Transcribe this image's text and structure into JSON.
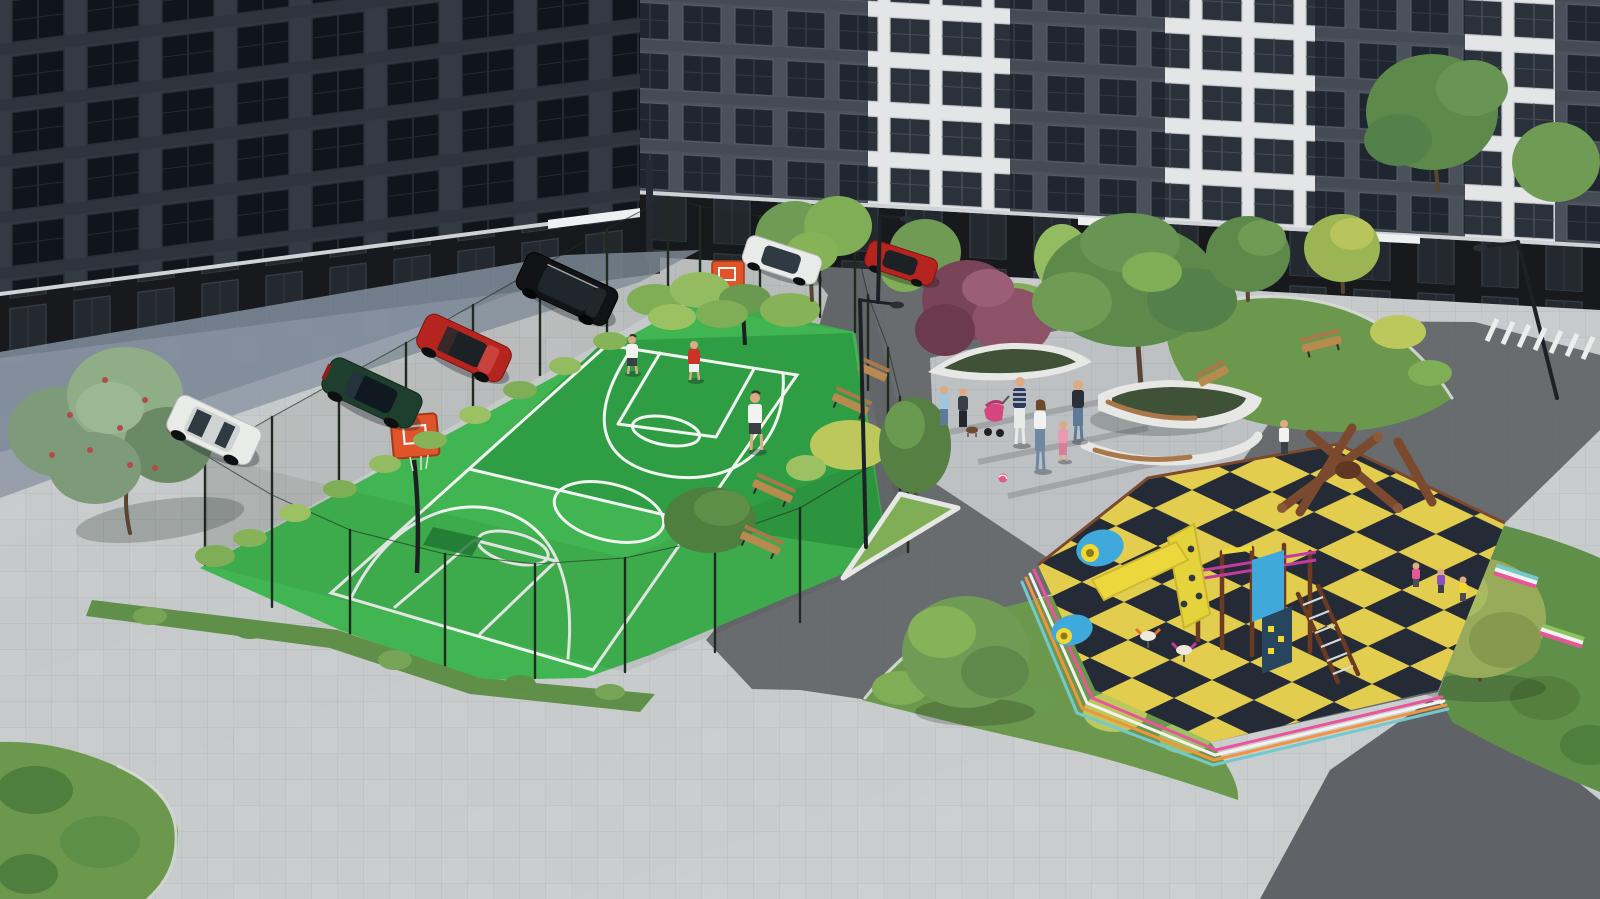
{
  "meta": {
    "title": "Courtyard 3D architectural render",
    "description": "Aerial visualization of a residential courtyard with basketball court, playground, plaza with people, parked cars and landscaping",
    "style": "photorealistic-render"
  },
  "palette": {
    "pavement_light": "#c6c9ca",
    "pavement_tile_line": "rgba(70,75,80,0.12)",
    "pavement_shadow": "#8a95a3",
    "pavement_shadow_deep": "#6f7e8e",
    "path_dark": "#696c6f",
    "path_corner": "#5f6266",
    "plaza_light": "#bec1c3",
    "building_left": "#3a3f49",
    "building_right": "#4b515b",
    "building_white": "#e3e5e7",
    "window_dark": "#10151c",
    "window_mid": "#1f2630",
    "window_on_white": "#2a313b",
    "storefront": "#17191d",
    "door": "#262a31",
    "awning": "#eef0f1",
    "court_green": "#41b551",
    "court_green_dark": "#2f9d43",
    "court_line": "#f1f5f1",
    "court_worn": "#1f7a33",
    "hoop_orange": "#e0542a",
    "fence": "#1f2b20",
    "grass": "#6b984d",
    "grass_dark": "#5f8f49",
    "bush_green": "#7fae57",
    "bush_light": "#9cc162",
    "bush_yellow": "#bcc75c",
    "tree_green": "#5d8a4a",
    "tree_light": "#6f9b55",
    "tree_purple": "#7a4458",
    "tree_purple_light": "#9a5f74",
    "berry_red": "#b34b4b",
    "bench_wood": "#b98a50",
    "play_yellow": "#e3cd4f",
    "play_navy": "#242b36",
    "play_wood": "#7b4a2e",
    "play_magenta": "#c23ba2",
    "play_blue": "#3fa9dc",
    "play_bright_yellow": "#ecd73c",
    "stripe_pink": "#e9559b",
    "stripe_white": "#f2f2ef",
    "stripe_orange": "#ef953f",
    "stripe_teal": "#74c9cf",
    "car_white": "#e9ebe9",
    "car_green": "#1f3f2e",
    "car_red": "#b5241f",
    "car_black": "#121316",
    "glass": "#1c2125",
    "skin": "#dcab85",
    "shirt_red": "#cc3328",
    "shirt_white": "#f2f2f0",
    "jeans": "#5d7globe"
  },
  "scene": {
    "buildings": {
      "label": "apartment blocks",
      "floors_visible": 5,
      "ground_floor": "dark storefronts",
      "facade_styles": [
        "dark gray panels",
        "white framed sections"
      ]
    },
    "basketball_court": {
      "label": "fenced basketball court",
      "players": 3,
      "player_shirts": [
        "white",
        "white",
        "red"
      ],
      "hoops": 2,
      "fence_posts": 23,
      "surface": "green with white markings"
    },
    "playground": {
      "label": "children playground",
      "surface": "yellow and dark-navy checkerboard rubber",
      "equipment": [
        "wooden log climber",
        "tower with slide",
        "climbing wall",
        "ladder",
        "tunnels",
        "spring riders"
      ],
      "children": 4
    },
    "plaza": {
      "label": "central plaza",
      "people": 8,
      "stroller": 1,
      "ball": 1,
      "planters": 3,
      "benches_wood": 6,
      "benches_rainbow": 2
    },
    "parking": {
      "cars": [
        {
          "color": "white",
          "type": "suv"
        },
        {
          "color": "dark-green",
          "type": "sedan"
        },
        {
          "color": "red",
          "type": "coupe"
        },
        {
          "color": "black",
          "type": "suv"
        },
        {
          "color": "white",
          "type": "sedan"
        },
        {
          "color": "red",
          "type": "sedan"
        }
      ]
    },
    "street_furniture": {
      "lamps": 3,
      "crosswalk_stripes": 7
    },
    "vegetation": {
      "large_trees": 10,
      "purple_tree": 1,
      "berry_tree": 1,
      "hedges_and_bushes": "many",
      "grass_beds": 6
    }
  }
}
